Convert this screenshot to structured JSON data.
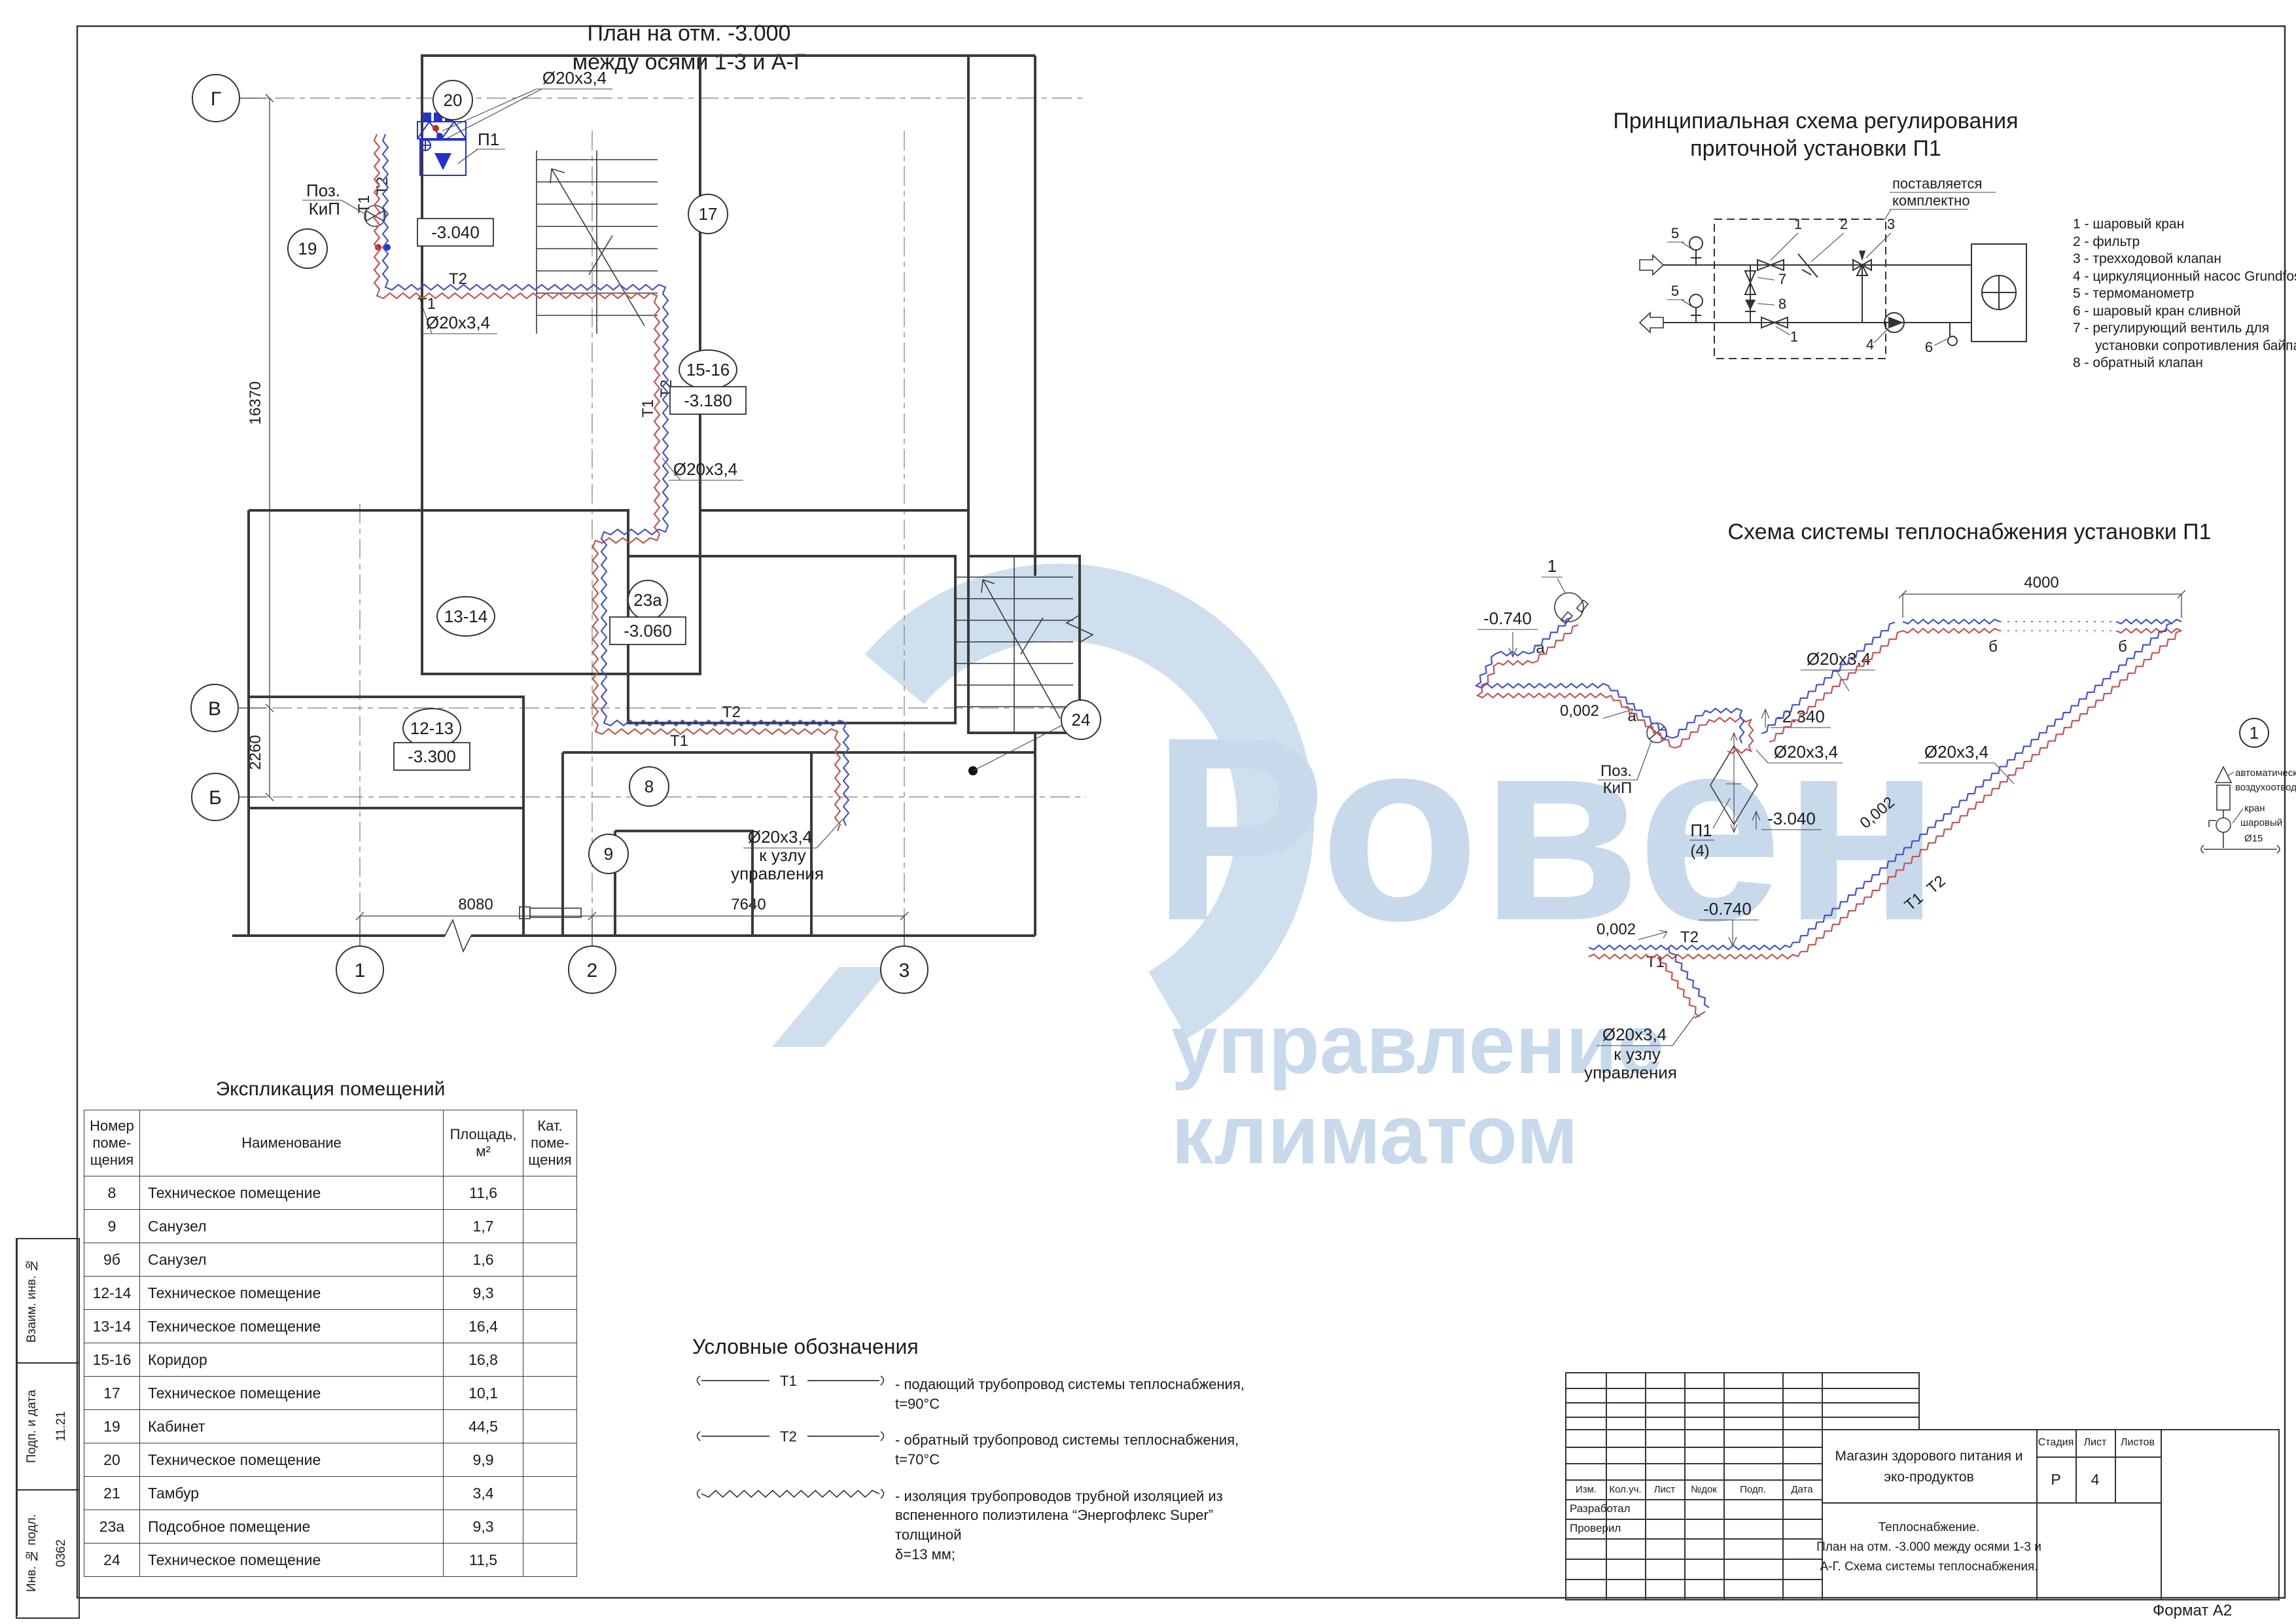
{
  "sheet": {
    "format": "Формат А2"
  },
  "watermark": {
    "w1": "Ровен",
    "w2": "управление",
    "w3": "климатом"
  },
  "plan": {
    "title1": "План на отм. -3.000",
    "title2": "между осями 1-3 и А-Г",
    "axes": {
      "g": "Г",
      "v": "В",
      "b": "Б",
      "a1": "1",
      "a2": "2",
      "a3": "3"
    },
    "dims": {
      "v16370": "16370",
      "v2260": "2260",
      "w8080": "8080",
      "w7640": "7640"
    },
    "rooms": {
      "r20": "20",
      "r17": "17",
      "r1516": "15-16",
      "r19": "19",
      "r1314": "13-14",
      "r23a": "23а",
      "r1213": "12-13",
      "r8": "8",
      "r9": "9",
      "r24": "24"
    },
    "elev": {
      "e3040": "-3.040",
      "e3180": "-3.180",
      "e3060": "-3.060",
      "e3300": "-3.300"
    },
    "pipe": {
      "t1": "T1",
      "t2": "T2",
      "d20": "Ø20x3,4",
      "to1": "к узлу",
      "to2": "управления",
      "p1": "П1",
      "poz": "Поз.",
      "kip": "КиП"
    }
  },
  "scheme1": {
    "title1": "Принципиальная схема регулирования",
    "title2": "приточной установки П1",
    "note1": "поставляется",
    "note2": "комплектно",
    "nums": {
      "n1": "1",
      "n2": "2",
      "n3": "3",
      "n4": "4",
      "n5": "5",
      "n6": "6",
      "n7": "7",
      "n8": "8"
    },
    "legend": [
      "1 - шаровый кран",
      "2 - фильтр",
      "3 - трехходовой клапан",
      "4 - циркуляционный насос Grundfos",
      "5 - термоманометр",
      "6 - шаровый кран сливной",
      "7 - регулирующий вентиль для",
      "установки сопротивления байпаса",
      "8 - обратный клапан"
    ]
  },
  "scheme2": {
    "title": "Схема системы теплоснабжения установки П1",
    "dim4000": "4000",
    "e0740": "-0.740",
    "e2340": "-2.340",
    "e3040": "-3.040",
    "slope": "0,002",
    "d20": "Ø20x3,4",
    "t1": "T1",
    "t2": "T2",
    "a": "а",
    "b": "б",
    "p1": "П1",
    "p1n": "(4)",
    "poz": "Поз.",
    "kip": "КиП",
    "one": "1",
    "to1": "к узлу",
    "to2": "управления",
    "detail": {
      "l1": "автоматический",
      "l2": "воздухоотводчик",
      "l3": "кран",
      "l4": "шаровый",
      "l5": "Ø15"
    }
  },
  "explication": {
    "title": "Экспликация помещений",
    "headers": [
      "Номер\nпоме-\nщения",
      "Наименование",
      "Площадь,\nм²",
      "Кат.\nпоме-\nщения"
    ],
    "rows": [
      [
        "8",
        "Техническое помещение",
        "11,6"
      ],
      [
        "9",
        "Санузел",
        "1,7"
      ],
      [
        "9б",
        "Санузел",
        "1,6"
      ],
      [
        "12-14",
        "Техническое помещение",
        "9,3"
      ],
      [
        "13-14",
        "Техническое помещение",
        "16,4"
      ],
      [
        "15-16",
        "Коридор",
        "16,8"
      ],
      [
        "17",
        "Техническое помещение",
        "10,1"
      ],
      [
        "19",
        "Кабинет",
        "44,5"
      ],
      [
        "20",
        "Техническое помещение",
        "9,9"
      ],
      [
        "21",
        "Тамбур",
        "3,4"
      ],
      [
        "23а",
        "Подсобное помещение",
        "9,3"
      ],
      [
        "24",
        "Техническое помещение",
        "11,5"
      ]
    ]
  },
  "legend": {
    "title": "Условные обозначения",
    "sym1": "T1",
    "sym2": "T2",
    "item1": "-  подающий трубопровод системы теплоснабжения, t=90°C",
    "item2": "-  обратный трубопровод системы теплоснабжения, t=70°C",
    "item3a": "-  изоляция трубопроводов трубной изоляцией из",
    "item3b": "вспененного полиэтилена “Энергофлекс Super” толщиной",
    "item3c": "δ=13 мм;"
  },
  "titleblock": {
    "cols": [
      "Изм.",
      "Кол.уч.",
      "Лист",
      "№док",
      "Подп.",
      "Дата"
    ],
    "r1": "Разработал",
    "r2": "Проверил",
    "object1": "Магазин здорового питания и",
    "object2": "эко-продуктов",
    "doc1": "Теплоснабжение.",
    "doc2": "План на отм. -3.000 между осями 1-3 и",
    "doc3": "А-Г. Схема системы теплоснабжения.",
    "stage_l": "Стадия",
    "sheet_l": "Лист",
    "sheets_l": "Листов",
    "stage_v": "Р",
    "sheet_v": "4"
  },
  "sidebar": {
    "vzam": "Взаим. инв. №",
    "podp": "Подп. и дата",
    "podp_val": "11.21",
    "inv": "Инв. № подл.",
    "inv_val": "0362"
  }
}
